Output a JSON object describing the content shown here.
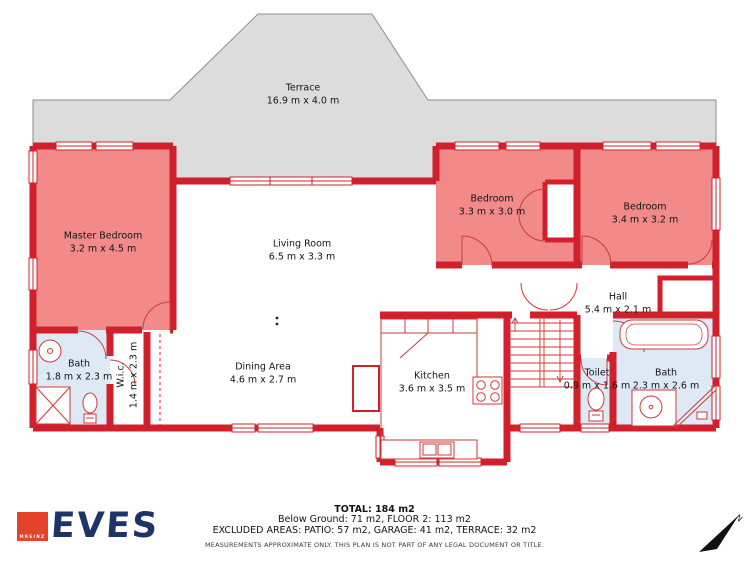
{
  "plan": {
    "terrace": {
      "name": "Terrace",
      "dims": "16.9 m x 4.0 m"
    },
    "master_bedroom": {
      "name": "Master Bedroom",
      "dims": "3.2 m x 4.5 m"
    },
    "living_room": {
      "name": "Living Room",
      "dims": "6.5 m x 3.3 m"
    },
    "bedroom_small": {
      "name": "Bedroom",
      "dims": "3.3 m x 3.0 m"
    },
    "bedroom_large": {
      "name": "Bedroom",
      "dims": "3.4 m x 3.2 m"
    },
    "hall": {
      "name": "Hall",
      "dims": "5.4 m x 2.1 m"
    },
    "bath_left": {
      "name": "Bath",
      "dims": "1.8 m x 2.3 m"
    },
    "wic": {
      "name": "W.i.c.",
      "dims": "1.4 m x 2.3 m"
    },
    "dining": {
      "name": "Dining Area",
      "dims": "4.6 m x 2.7 m"
    },
    "kitchen": {
      "name": "Kitchen",
      "dims": "3.6 m x 3.5 m"
    },
    "toilet": {
      "name": "Toilet",
      "dims": "0.9 m x 1.6 m"
    },
    "bath_right": {
      "name": "Bath",
      "dims": "2.3 m x 2.6 m"
    }
  },
  "footer": {
    "total": "TOTAL: 184 m2",
    "areas_line": "Below Ground: 71 m2, FLOOR 2: 113 m2",
    "excluded_line": "EXCLUDED AREAS: PATIO: 57 m2, GARAGE: 41 m2, TERRACE: 32 m2",
    "disclaimer": "MEASUREMENTS APPROXIMATE ONLY. THIS PLAN IS NOT PART OF ANY LEGAL DOCUMENT OR TITLE."
  },
  "logo": {
    "brand": "EVES",
    "badge": "MREINZ"
  },
  "compass": {
    "north_label": "N"
  },
  "colors": {
    "wall_red": "#d1202b",
    "room_pink": "#f28a8a",
    "room_blue": "#ddeaf6",
    "terrace_gray": "#dcdcdc",
    "logo_navy": "#1c3566",
    "logo_red": "#e2432a"
  }
}
